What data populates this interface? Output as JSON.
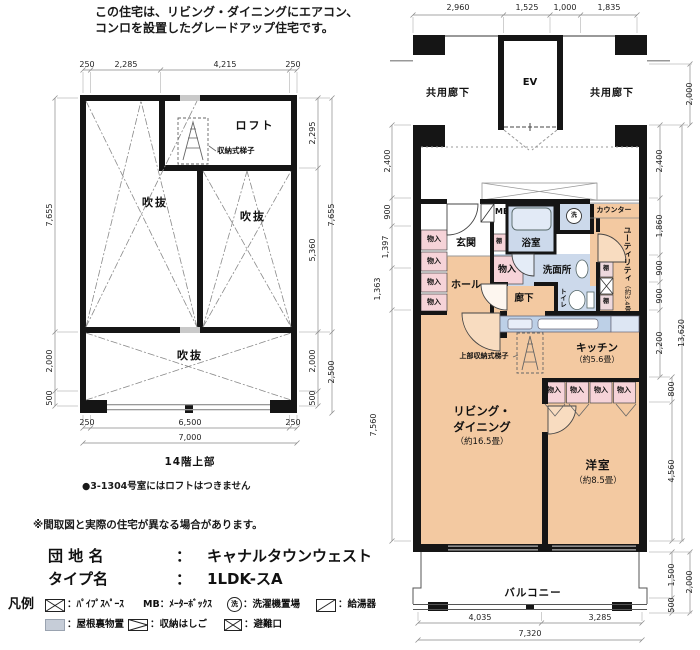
{
  "hd": {
    "l1": "この住宅は、リビング・ダイニングにエアコン、",
    "l2": "コンロを設置したグレードアップ住宅です。"
  },
  "lp": {
    "loft": "ロフト",
    "void": "吹抜",
    "ladder": "収納式梯子",
    "title": "14階上部",
    "note": "●3-1304号室にはロフトはつきません",
    "dt": [
      "250",
      "2,285",
      "4,215",
      "250"
    ],
    "db": [
      "250",
      "6,500",
      "250",
      "7,000"
    ],
    "dl": [
      "7,655",
      "2,000",
      "500"
    ],
    "dr": [
      "2,295",
      "5,360",
      "2,000",
      "500",
      "7,655",
      "2,500"
    ]
  },
  "rp": {
    "corridor": "共用廊下",
    "ev": "EV",
    "genkan": "玄関",
    "hall": "ホール",
    "rouka": "廊下",
    "closet": "物入",
    "shelf": "棚",
    "mb": "MB",
    "bath": "浴室",
    "wash": "洗",
    "washroom": "洗面所",
    "toilet": "トイレ",
    "counter": "カウンター",
    "utility": "ユーティリティ",
    "utility_size": "（約3.4畳）",
    "kitchen": "キッチン",
    "kitchen_size": "（約5.6畳）",
    "upper_ladder": "上部収納式梯子",
    "living1": "リビング・",
    "living2": "ダイニング",
    "living_size": "（約16.5畳）",
    "bedroom": "洋室",
    "bedroom_size": "（約8.5畳）",
    "balcony": "バルコニー",
    "dt": [
      "2,960",
      "1,525",
      "1,000",
      "1,835"
    ],
    "dl": [
      "2,400",
      "900",
      "1,397",
      "1,363",
      "7,560"
    ],
    "dri": [
      "2,400",
      "1,860",
      "900",
      "900",
      "2,200",
      "800",
      "4,560",
      "1,500",
      "500"
    ],
    "dro": [
      "13,620",
      "2,000"
    ],
    "drt": "2,000",
    "db": [
      "4,035",
      "3,285",
      "7,320"
    ]
  },
  "ft": {
    "note": "※間取図と実際の住宅が異なる場合があります。",
    "estate_label": "団 地 名",
    "colon": "：",
    "estate": "キャナルタウンウェスト",
    "type_label": "タイプ名",
    "type": "1LDK-スA"
  },
  "lg": {
    "title": "凡例",
    "i1": "：ﾊﾟｲﾌﾟｽﾍﾟｰｽ",
    "mb": "MB",
    "i2": "：ﾒｰﾀｰﾎﾞｯｸｽ",
    "wash": "洗",
    "i3": "：洗濯機置場",
    "i4": "：給湯器",
    "i5": "：屋根裏物置",
    "i6": "：収納はしご",
    "i7": "：避難口"
  }
}
